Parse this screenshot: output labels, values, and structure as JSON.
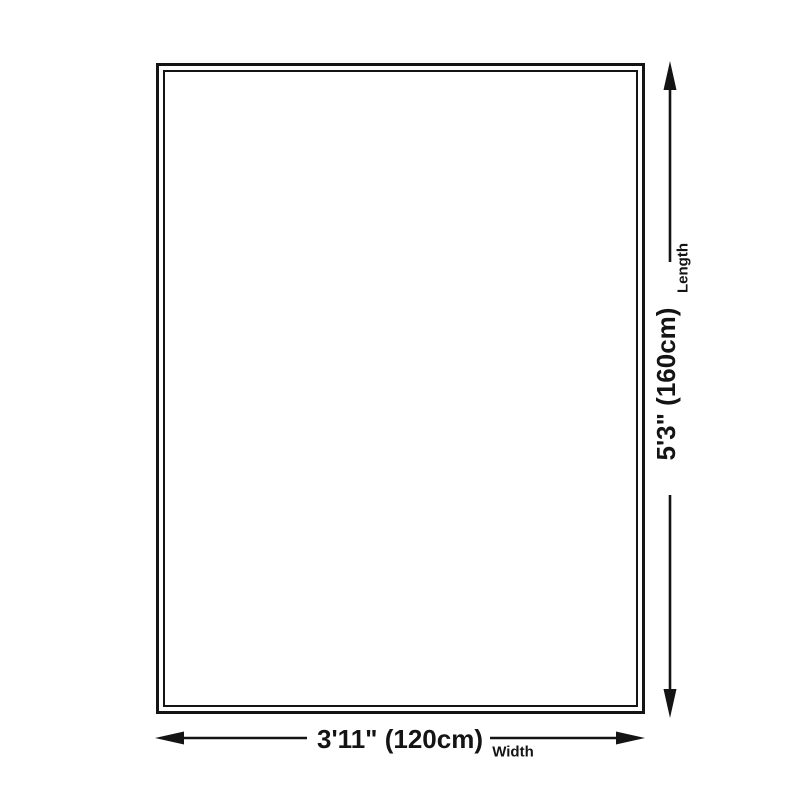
{
  "diagram": {
    "name": "rug-size-diagram"
  },
  "dimensions": {
    "length": {
      "value": "5'3\" (160cm)",
      "label": "Length"
    },
    "width": {
      "value": "3'11\" (120cm)",
      "label": "Width"
    }
  },
  "colors": {
    "ink": "#141414",
    "background": "#ffffff"
  }
}
